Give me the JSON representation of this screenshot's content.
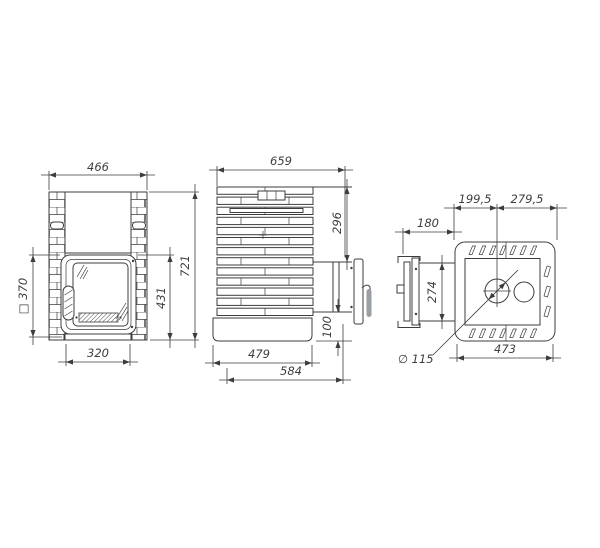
{
  "drawing": {
    "type": "technical-three-view-stove-drawing",
    "colors": {
      "line": "#3d3d3d",
      "text": "#3d3d3d",
      "handle_fill": "#999fa4",
      "background": "#ffffff"
    },
    "views": {
      "front": {
        "labels": {
          "overall_width": "466",
          "door_square": "□ 370",
          "base_width": "320",
          "door_section_height": "431",
          "overall_height": "721"
        }
      },
      "side": {
        "labels": {
          "overall_depth": "659",
          "top_to_door_height": "296",
          "base_section_height": "100",
          "base_depth": "479",
          "overall_depth_with_handle": "584"
        }
      },
      "top": {
        "labels": {
          "rear_to_flue_center": "199,5",
          "flue_center_to_front": "279,5",
          "door_projection": "180",
          "door_width": "274",
          "flue_diameter": "∅ 115",
          "body_depth": "473"
        }
      }
    }
  }
}
